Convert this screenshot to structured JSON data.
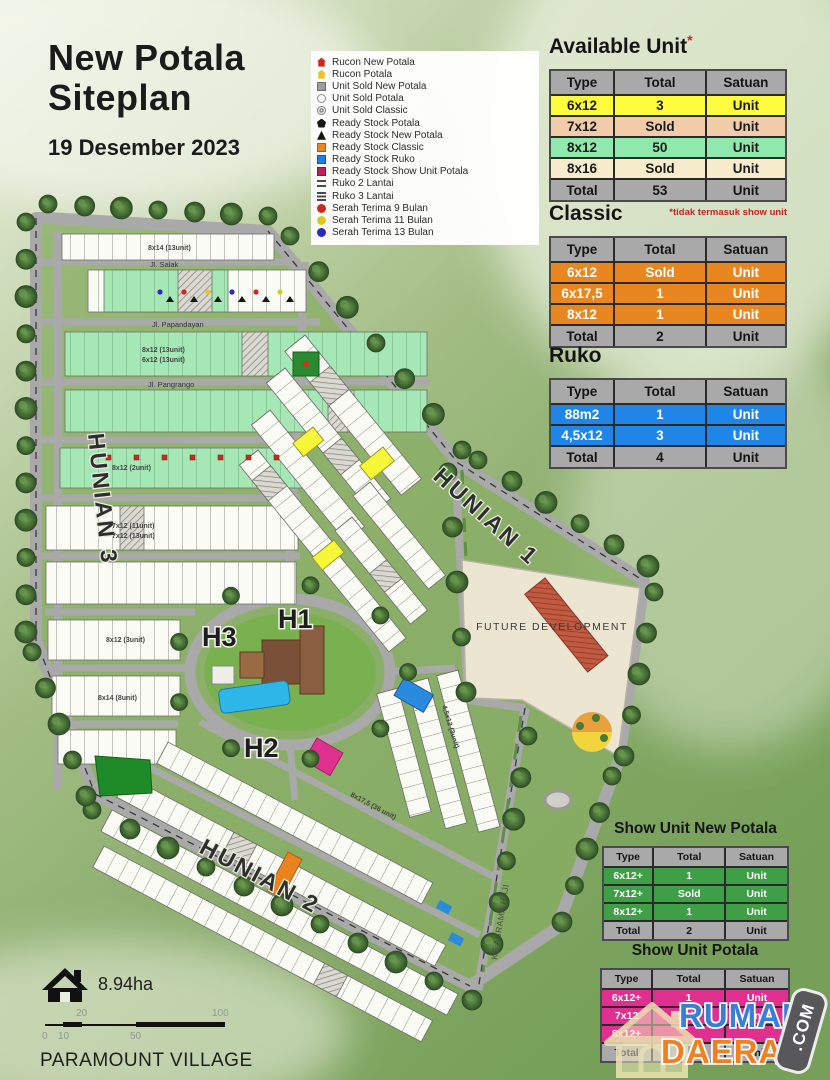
{
  "header": {
    "title_line1": "New Potala",
    "title_line2": "Siteplan",
    "date": "19 Desember 2023"
  },
  "legend": {
    "items": [
      {
        "label": "Rucon New Potala",
        "icon": "house",
        "color": "#cc2a1f",
        "icon_name": "red-house-icon"
      },
      {
        "label": "Rucon Potala",
        "icon": "house",
        "color": "#e7c52e",
        "icon_name": "yellow-house-icon"
      },
      {
        "label": "Unit Sold New Potala",
        "icon": "square",
        "color": "#9e9e9e",
        "icon_name": "gray-square-icon"
      },
      {
        "label": "Unit Sold Potala",
        "icon": "circle-outline",
        "color": "#8a8a8a",
        "icon_name": "circle-outline-icon"
      },
      {
        "label": "Unit Sold Classic",
        "icon": "circle-double",
        "color": "#7a7a7a",
        "icon_name": "double-circle-icon"
      },
      {
        "label": "Ready Stock Potala",
        "icon": "pentagon",
        "color": "#141414",
        "icon_name": "black-pentagon-icon"
      },
      {
        "label": "Ready Stock New Potala",
        "icon": "triangle",
        "color": "#141414",
        "icon_name": "black-triangle-icon"
      },
      {
        "label": "Ready Stock Classic",
        "icon": "square",
        "color": "#e8871f",
        "icon_name": "orange-square-icon"
      },
      {
        "label": "Ready Stock Ruko",
        "icon": "square",
        "color": "#1f7fe0",
        "icon_name": "blue-square-icon"
      },
      {
        "label": "Ready Stock Show Unit Potala",
        "icon": "square",
        "color": "#c21f5e",
        "icon_name": "crimson-square-icon"
      },
      {
        "label": "Ruko 2 Lantai",
        "icon": "lines2",
        "color": "#4a4a4a",
        "icon_name": "two-lines-icon"
      },
      {
        "label": "Ruko 3 Lantai",
        "icon": "lines3",
        "color": "#4a4a4a",
        "icon_name": "three-lines-icon"
      },
      {
        "label": "Serah Terima 9 Bulan",
        "icon": "circle",
        "color": "#cc2a1f",
        "icon_name": "red-circle-icon"
      },
      {
        "label": "Serah Terima 11 Bulan",
        "icon": "circle",
        "color": "#d9cc1e",
        "icon_name": "yellow-circle-icon"
      },
      {
        "label": "Serah Terima 13 Bulan",
        "icon": "circle",
        "color": "#2a2ab8",
        "icon_name": "blue-circle-icon"
      }
    ]
  },
  "tables": [
    {
      "id": "available",
      "title": "Available Unit",
      "asterisk": "*",
      "footnote": "*tidak termasuk show unit",
      "columns": [
        "Type",
        "Total",
        "Satuan"
      ],
      "rows": [
        {
          "cells": [
            "6x12",
            "3",
            "Unit"
          ],
          "bg": "#fdfd3d",
          "fg": "#1a1a1a"
        },
        {
          "cells": [
            "7x12",
            "Sold",
            "Unit"
          ],
          "bg": "#f2cbaa",
          "fg": "#1a1a1a"
        },
        {
          "cells": [
            "8x12",
            "50",
            "Unit"
          ],
          "bg": "#8fe8ac",
          "fg": "#1a1a1a"
        },
        {
          "cells": [
            "8x16",
            "Sold",
            "Unit"
          ],
          "bg": "#f7eccb",
          "fg": "#1a1a1a"
        }
      ],
      "total": [
        "Total",
        "53",
        "Unit"
      ]
    },
    {
      "id": "classic",
      "title": "Classic",
      "columns": [
        "Type",
        "Total",
        "Satuan"
      ],
      "rows": [
        {
          "cells": [
            "6x12",
            "Sold",
            "Unit"
          ],
          "bg": "#e8871f",
          "fg": "#ffffff"
        },
        {
          "cells": [
            "6x17,5",
            "1",
            "Unit"
          ],
          "bg": "#e8871f",
          "fg": "#ffffff"
        },
        {
          "cells": [
            "8x12",
            "1",
            "Unit"
          ],
          "bg": "#e8871f",
          "fg": "#ffffff"
        }
      ],
      "total": [
        "Total",
        "2",
        "Unit"
      ]
    },
    {
      "id": "ruko",
      "title": "Ruko",
      "columns": [
        "Type",
        "Total",
        "Satuan"
      ],
      "rows": [
        {
          "cells": [
            "88m2",
            "1",
            "Unit"
          ],
          "bg": "#1f86e8",
          "fg": "#ffffff"
        },
        {
          "cells": [
            "4,5x12",
            "3",
            "Unit"
          ],
          "bg": "#1f86e8",
          "fg": "#ffffff"
        }
      ],
      "total": [
        "Total",
        "4",
        "Unit"
      ]
    },
    {
      "id": "show-new",
      "title": "Show Unit New Potala",
      "columns": [
        "Type",
        "Total",
        "Satuan"
      ],
      "rows": [
        {
          "cells": [
            "6x12+",
            "1",
            "Unit"
          ],
          "bg": "#3f9f46",
          "fg": "#ffffff"
        },
        {
          "cells": [
            "7x12+",
            "Sold",
            "Unit"
          ],
          "bg": "#3f9f46",
          "fg": "#ffffff"
        },
        {
          "cells": [
            "8x12+",
            "1",
            "Unit"
          ],
          "bg": "#3f9f46",
          "fg": "#ffffff"
        }
      ],
      "total": [
        "Total",
        "2",
        "Unit"
      ]
    },
    {
      "id": "show-potala",
      "title": "Show Unit Potala",
      "columns": [
        "Type",
        "Total",
        "Satuan"
      ],
      "rows": [
        {
          "cells": [
            "6x12+",
            "1",
            "Unit"
          ],
          "bg": "#e0308f",
          "fg": "#ffffff"
        },
        {
          "cells": [
            "7x12",
            "Sold",
            "Unit"
          ],
          "bg": "#e0308f",
          "fg": "#ffffff"
        },
        {
          "cells": [
            "8x12+",
            "",
            ""
          ],
          "bg": "#e0308f",
          "fg": "#ffffff"
        }
      ],
      "total": [
        "Total",
        "",
        "Unit"
      ]
    }
  ],
  "map": {
    "region_labels": {
      "h1": "H1",
      "h2": "H2",
      "h3": "H3"
    },
    "boundary_labels": {
      "hunian1": "HUNIAN 1",
      "hunian2": "HUNIAN 2",
      "hunian3": "HUNIAN 3"
    },
    "future_development": "FUTURE DEVELOPMENT",
    "streets": {
      "salak": "Jl. Salak",
      "papandayan": "Jl. Papandayan",
      "pangrango": "Jl. Pangrango",
      "asrama": "KE ASRAMA HAJI"
    },
    "annotations": [
      "8x14 (13unit)",
      "8x12 (13unit)",
      "6x12 (13unit)",
      "8x12 (2unit)",
      "7x12 (11unit)",
      "7x12 (13unit)",
      "8x12 (3unit)",
      "8x14 (8unit)",
      "8x17,5 (36 unit)",
      "4,5x12 (3unit)"
    ]
  },
  "footer": {
    "area": "8.94ha",
    "scale_ticks": [
      "0",
      "10",
      "20",
      "50",
      "100"
    ],
    "village": "PARAMOUNT VILLAGE"
  },
  "watermark": {
    "word1": "RUMAH",
    "word2": "DAERAH",
    "badge": ".COM"
  }
}
